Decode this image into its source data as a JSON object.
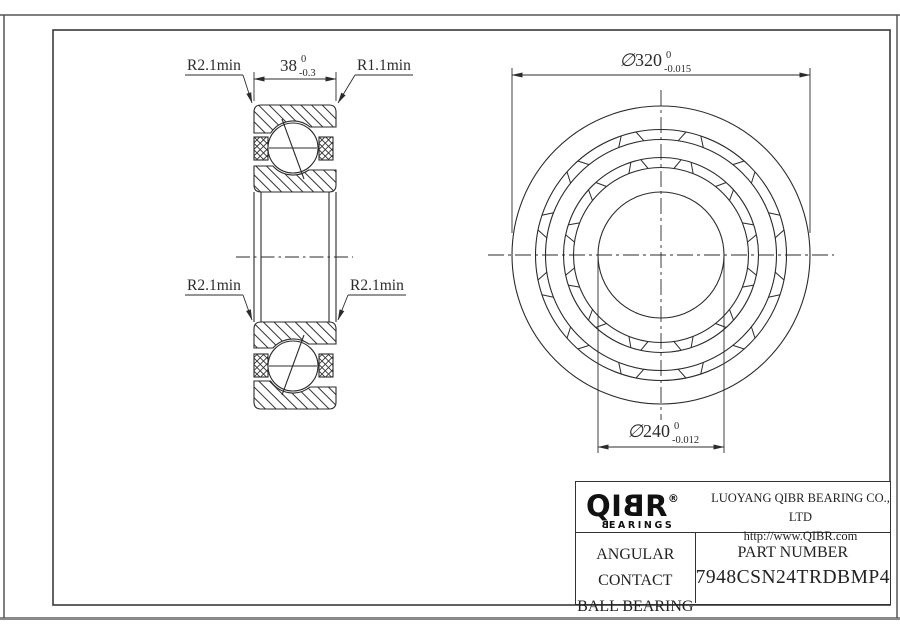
{
  "drawing": {
    "section_view": {
      "width_dim": {
        "value": "38",
        "tol_top": "0",
        "tol_bottom": "-0.3"
      },
      "radius_top_left": "R2.1min",
      "radius_top_right": "R1.1min",
      "radius_mid_left": "R2.1min",
      "radius_mid_right": "R2.1min"
    },
    "front_view": {
      "outer_dia": {
        "symbol": "∅",
        "value": "320",
        "tol_top": "0",
        "tol_bottom": "-0.015"
      },
      "bore_dia": {
        "symbol": "∅",
        "value": "240",
        "tol_top": "0",
        "tol_bottom": "-0.012"
      }
    }
  },
  "title_block": {
    "logo": {
      "part1": "QI",
      "part2_mirrored": "B",
      "part3": "R",
      "registered": "®",
      "sub_first_mirrored": "B",
      "sub_rest": "EARINGS"
    },
    "company_name": "LUOYANG QIBR BEARING CO., LTD",
    "website": "http://www.QIBR.com",
    "product_type_line1": "ANGULAR CONTACT",
    "product_type_line2": "BALL BEARING",
    "part_number_label": "PART NUMBER",
    "part_number": "7948CSN24TRDBMP4"
  },
  "colors": {
    "line": "#2b2b2b",
    "frame": "#3a3a3a",
    "border_gray": "#777777",
    "background": "#ffffff"
  }
}
